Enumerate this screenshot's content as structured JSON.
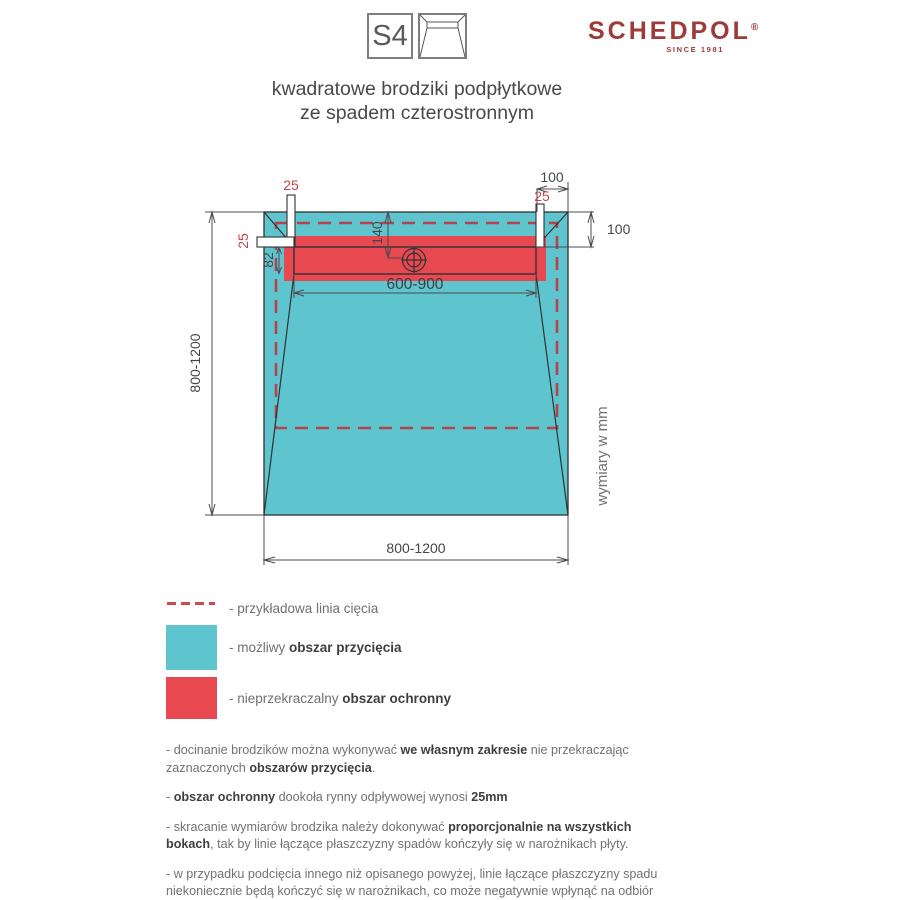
{
  "header": {
    "code": "S4",
    "brand": "SCHEDPOL",
    "brand_reg": "®",
    "brand_tagline": "SINCE 1981"
  },
  "title": {
    "line1": "kwadratowe brodziki podpłytkowe",
    "line2": "ze spadem czterostronnym"
  },
  "diagram": {
    "type": "technical-drawing",
    "subject": "square under-tile shower tray with four-sided slope, top view",
    "labels": {
      "top_margin_25": "25",
      "left_margin_25": "25",
      "right_margin_25": "25",
      "edge_offset_top": "100",
      "edge_offset_right": "100",
      "drain_offset": "140",
      "channel_width": "82",
      "channel_length_range": "600-900",
      "tray_height_range": "800-1200",
      "tray_width_range": "800-1200",
      "units_note": "wymiary w mm"
    },
    "colors": {
      "tray_area": "#5ec4ce",
      "protect_area": "#e8484f",
      "cut_line": "#b4434e",
      "dim_red_text": "#c4454b",
      "outline": "#303134"
    }
  },
  "legend": {
    "items": [
      {
        "swatch": "dashed-red-line",
        "prefix": "- przykładowa linia cięcia",
        "bold": ""
      },
      {
        "swatch": "cyan-square",
        "prefix": "- możliwy ",
        "bold": "obszar przycięcia"
      },
      {
        "swatch": "red-square",
        "prefix": "- nieprzekraczalny ",
        "bold": "obszar ochronny"
      }
    ]
  },
  "notes": [
    {
      "segs": [
        {
          "t": "- docinanie brodzików można wykonywać "
        },
        {
          "t": "we własnym zakresie"
        },
        {
          "t": " nie przekraczając zaznaczonych "
        },
        {
          "t": "obszarów przycięcia"
        },
        {
          "t": "."
        }
      ]
    },
    {
      "segs": [
        {
          "t": "- "
        },
        {
          "t": "obszar ochronny"
        },
        {
          "t": " dookoła rynny odpływowej wynosi "
        },
        {
          "t": "25mm"
        }
      ]
    },
    {
      "segs": [
        {
          "t": "- skracanie wymiarów brodzika należy dokonywać "
        },
        {
          "t": "proporcjonalnie na wszystkich bokach"
        },
        {
          "t": ", tak by linie łączące płaszczyzny spadów kończyły się w narożnikach płyty."
        }
      ]
    },
    {
      "segs": [
        {
          "t": "- w przypadku podcięcia innego niż opisanego powyżej, linie łączące płaszczyzny spadu niekoniecznie będą kończyć się w narożnikach, co może negatywnie wpłynąć na odbiór estetyczny ułożonych (na tak przyciętym brodziku) płytek."
        }
      ]
    }
  ]
}
